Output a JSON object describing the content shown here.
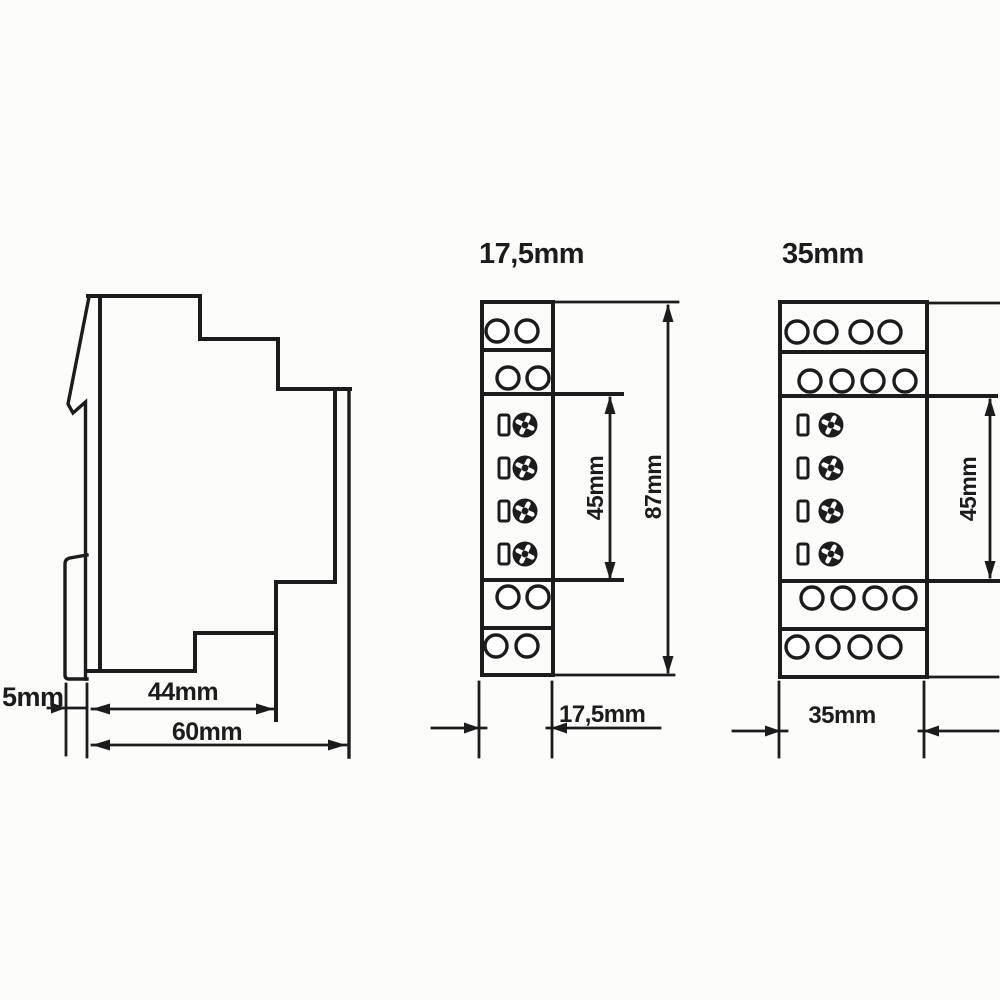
{
  "colors": {
    "ink": "#1c1c1c",
    "paper": "#fcfcfb"
  },
  "side_view": {
    "dim_clip_depth": "5mm",
    "dim_body_depth": "44mm",
    "dim_total_depth": "60mm"
  },
  "module_17_5": {
    "title": "17,5mm",
    "dim_width": "17,5mm",
    "dim_body_height": "45mm",
    "dim_total_height": "87mm"
  },
  "module_35": {
    "title": "35mm",
    "dim_width": "35mm",
    "dim_body_height": "45mm"
  }
}
